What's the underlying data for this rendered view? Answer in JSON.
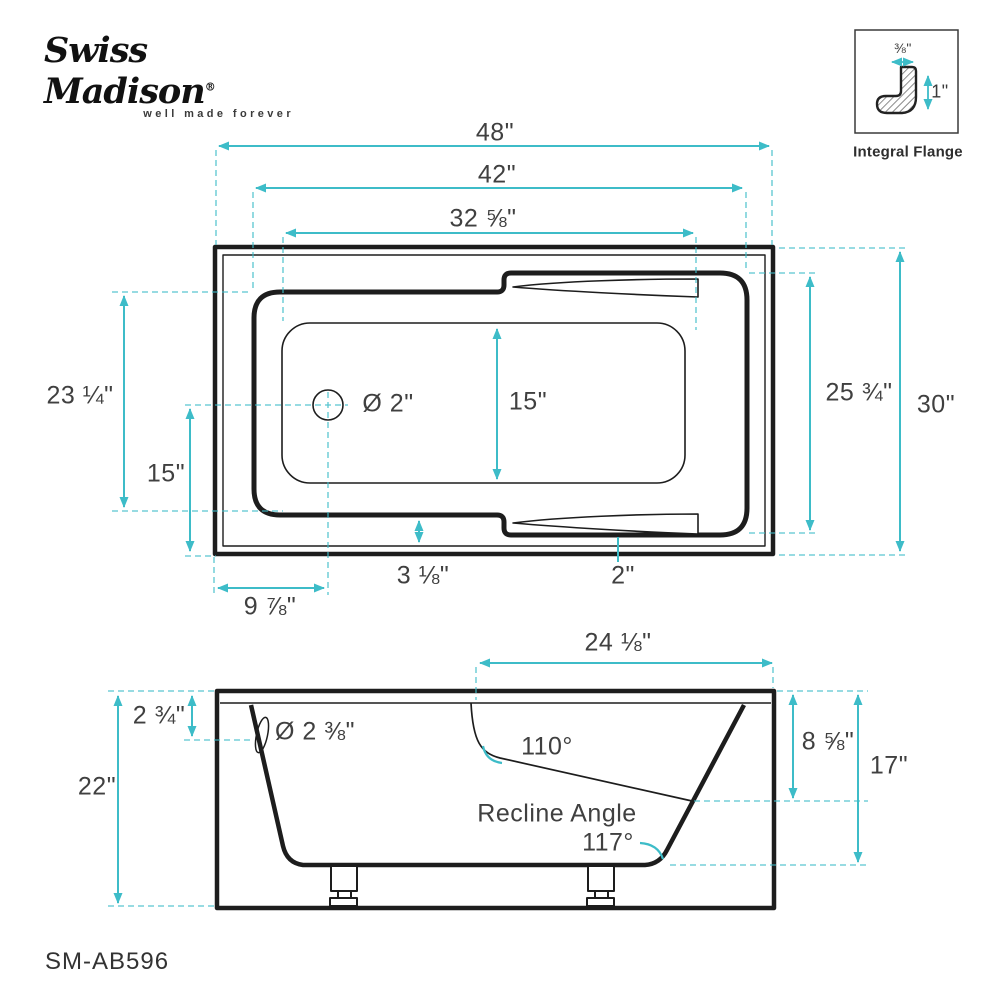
{
  "logo": {
    "brand": "Swiss Madison",
    "registered": "®",
    "tagline": "well made forever"
  },
  "model_number": "SM-AB596",
  "colors": {
    "dimension_teal": "#3dbcc8",
    "drawing_black": "#1d1d1d",
    "label_gray": "#404040"
  },
  "flange_detail": {
    "title": "Integral Flange",
    "width": "⅜\"",
    "height": "1\""
  },
  "top_view": {
    "overall_length": "48\"",
    "rim_length": "42\"",
    "basin_length": "32 ⅝\"",
    "rim_width_left": "23 ¼\"",
    "drain_to_edge": "15\"",
    "drain_diameter": "Ø 2\"",
    "basin_width": "15\"",
    "rim_width_right": "25 ¾\"",
    "overall_width": "30\"",
    "deck_gap": "3 ⅛\"",
    "armrest_width": "2\"",
    "drain_offset": "9 ⅞\""
  },
  "side_view": {
    "deck_length": "24 ⅛\"",
    "rim_thickness": "2 ¾\"",
    "overflow_diameter": "Ø 2 ⅜\"",
    "backrest_angle": "110°",
    "recline_label": "Recline Angle",
    "recline_angle": "117°",
    "backrest_height": "8 ⅝\"",
    "interior_depth": "17\"",
    "overall_height": "22\""
  }
}
